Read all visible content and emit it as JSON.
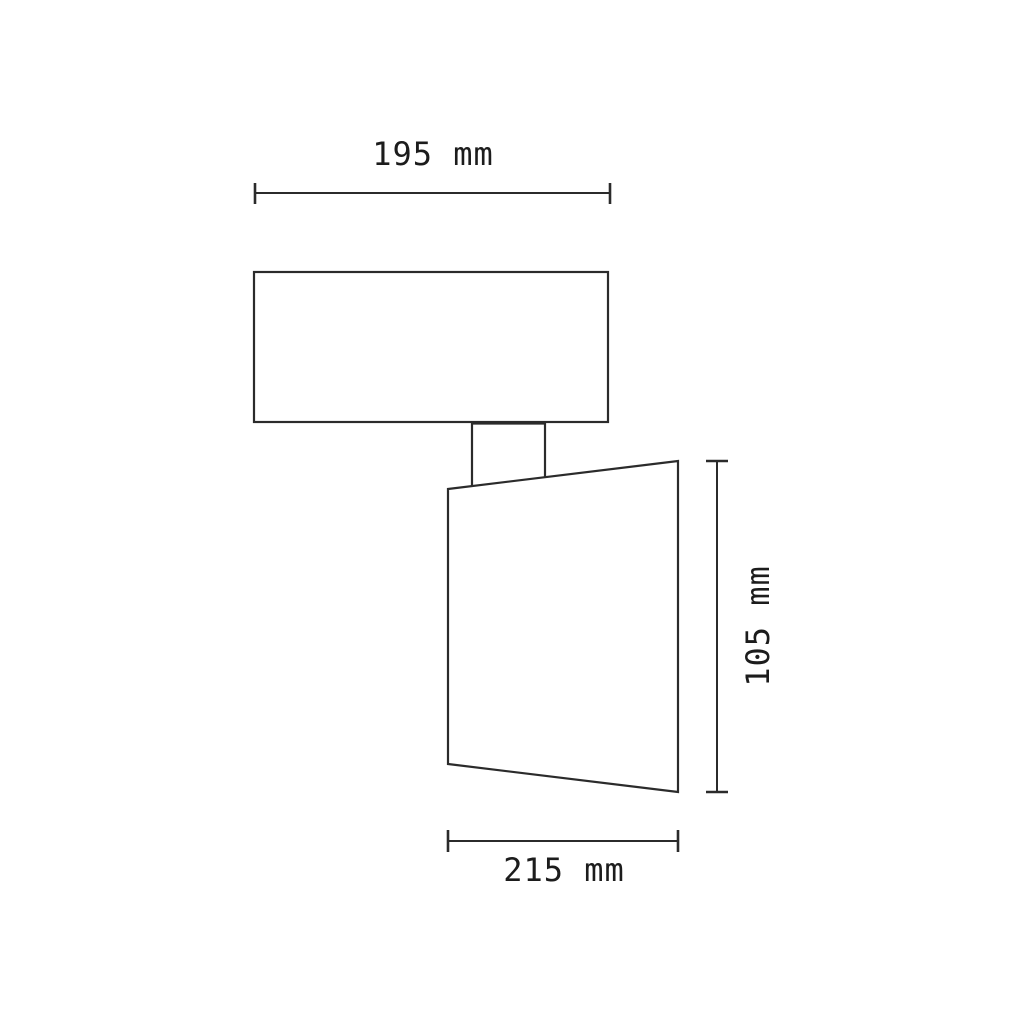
{
  "drawing": {
    "type": "technical-dimension-drawing",
    "subject": "wall-mounted spotlight, side view",
    "labels": {
      "top_width": "195 mm",
      "side_height": "105 mm",
      "bottom_width": "215 mm"
    },
    "colors": {
      "line": "#2b2b2b",
      "text": "#1c1c1c",
      "background": "#ffffff"
    }
  }
}
